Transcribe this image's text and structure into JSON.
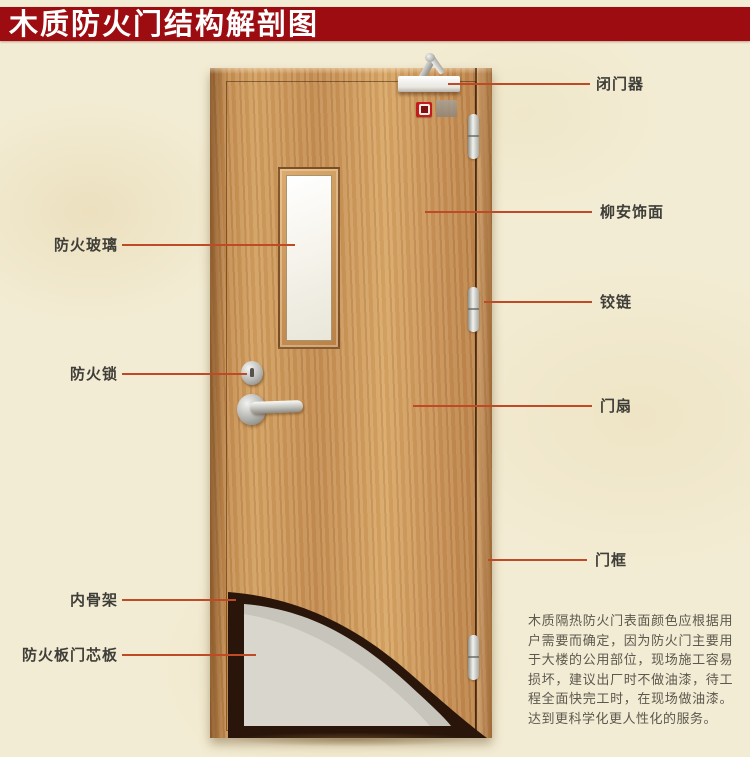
{
  "banner": {
    "title": "木质防火门结构解剖图"
  },
  "labels": {
    "fire_glass": "防火玻璃",
    "fire_lock": "防火锁",
    "inner_skeleton": "内骨架",
    "core_board": "防火板门芯板",
    "door_closer": "闭门器",
    "veneer": "柳安饰面",
    "hinge": "铰链",
    "door_leaf": "门扇",
    "door_frame": "门框"
  },
  "description": "木质隔热防火门表面颜色应根据用户需要而确定，因为防火门主要用于大楼的公用部位，现场施工容易损坏，建议出厂时不做油漆，待工程全面快完工时，在现场做油漆。达到更科学化更人性化的服务。",
  "colors": {
    "background": "#f3ecd4",
    "banner_bg": "#9c0c10",
    "banner_text": "#ffffff",
    "leader_line": "#bf4a26",
    "label_text": "#3f3e38",
    "wood": "#cd9a5e",
    "glass": "#f7f6f1",
    "core_gray": "#d8d6cd",
    "skeleton_dark": "#2a150a"
  }
}
